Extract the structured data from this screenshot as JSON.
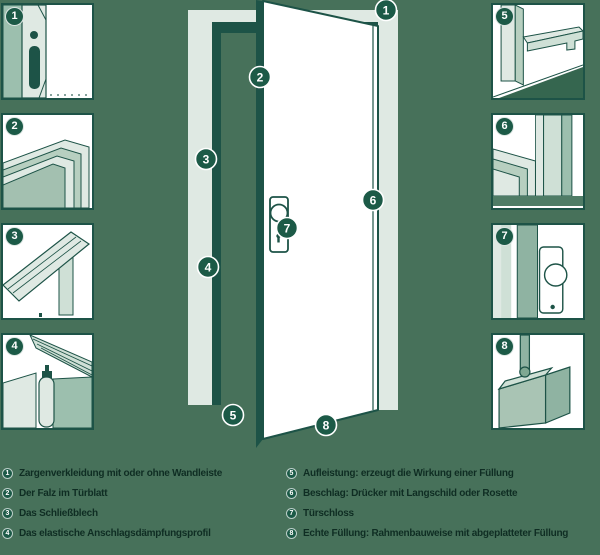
{
  "theme": {
    "background": "#47715a",
    "outline_dark_green": "#1d5347",
    "badge_green": "#1c5a47",
    "legend_text_green": "#0f2d23",
    "pale_green": "#dfe9e3",
    "mid_green": "#b7cfc0",
    "sage_green": "#9cbfae",
    "deep_green": "#35664f",
    "door_white": "#ffffff"
  },
  "diagram_badges": [
    "1",
    "2",
    "3",
    "4",
    "5",
    "6",
    "7",
    "8"
  ],
  "thumbnails": [
    {
      "number": "1",
      "name": "zargenverkleidung-detail"
    },
    {
      "number": "2",
      "name": "falz-im-tuerblatt-detail"
    },
    {
      "number": "3",
      "name": "schliessblech-detail"
    },
    {
      "number": "4",
      "name": "anschlagsdaempfungsprofil-detail"
    },
    {
      "number": "5",
      "name": "aufleistung-detail"
    },
    {
      "number": "6",
      "name": "beschlag-detail"
    },
    {
      "number": "7",
      "name": "tuerschloss-detail"
    },
    {
      "number": "8",
      "name": "echte-fuellung-detail"
    }
  ],
  "legend": {
    "left": [
      {
        "number": "1",
        "text": "Zargenverkleidung mit oder ohne Wandleiste"
      },
      {
        "number": "2",
        "text": "Der Falz im Türblatt"
      },
      {
        "number": "3",
        "text": "Das Schließblech"
      },
      {
        "number": "4",
        "text": "Das elastische Anschlagsdämpfungsprofil"
      }
    ],
    "right": [
      {
        "number": "5",
        "text": "Aufleistung: erzeugt die Wirkung einer Füllung"
      },
      {
        "number": "6",
        "text": "Beschlag: Drücker mit Langschild oder Rosette"
      },
      {
        "number": "7",
        "text": "Türschloss"
      },
      {
        "number": "8",
        "text": "Echte Füllung: Rahmenbauweise mit abgeplatteter Füllung"
      }
    ]
  }
}
